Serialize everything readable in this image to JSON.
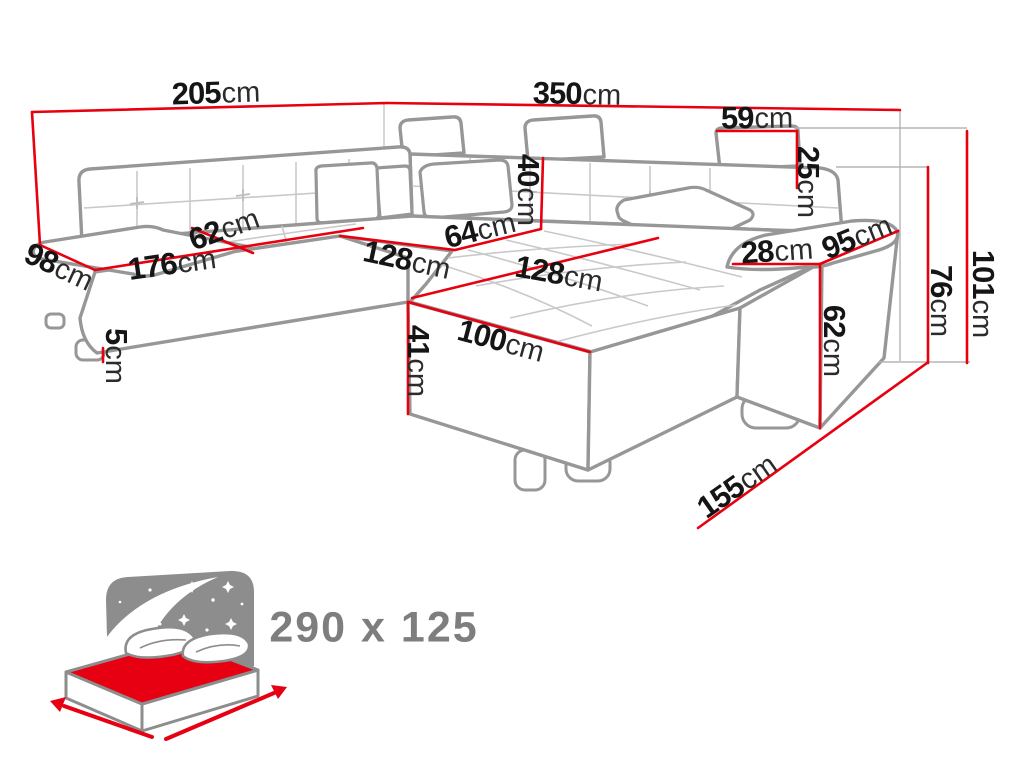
{
  "diagram": {
    "type": "sofa-dimension-diagram",
    "unit_default": "cm",
    "colors": {
      "dimension_line": "#e8000f",
      "outline_gray": "#979797",
      "seam_gray": "#c9c9c9",
      "label_text": "#151515",
      "icon_gray": "#8d8d8d",
      "icon_text": "#7e7e7e",
      "mattress_red": "#e60012"
    }
  },
  "dimensions": [
    {
      "name": "back-width-left",
      "value": "205",
      "unit": "cm"
    },
    {
      "name": "back-width-right",
      "value": "350",
      "unit": "cm"
    },
    {
      "name": "headrest-width",
      "value": "59",
      "unit": "cm"
    },
    {
      "name": "headrest-height",
      "value": "25",
      "unit": "cm"
    },
    {
      "name": "total-height",
      "value": "101",
      "unit": "cm"
    },
    {
      "name": "backrest-height",
      "value": "76",
      "unit": "cm"
    },
    {
      "name": "armrest-height",
      "value": "62",
      "unit": "cm"
    },
    {
      "name": "armrest-length",
      "value": "95",
      "unit": "cm"
    },
    {
      "name": "armrest-width",
      "value": "28",
      "unit": "cm"
    },
    {
      "name": "backrest-depth",
      "value": "40",
      "unit": "cm"
    },
    {
      "name": "seat-depth-corner",
      "value": "64",
      "unit": "cm"
    },
    {
      "name": "seat-depth-left",
      "value": "62",
      "unit": "cm"
    },
    {
      "name": "chaise-end-width",
      "value": "98",
      "unit": "cm"
    },
    {
      "name": "seat-length-left",
      "value": "176",
      "unit": "cm"
    },
    {
      "name": "seat-length-middle",
      "value": "128",
      "unit": "cm"
    },
    {
      "name": "seat-length-front",
      "value": "128",
      "unit": "cm"
    },
    {
      "name": "chaise-width",
      "value": "100",
      "unit": "cm"
    },
    {
      "name": "seat-height",
      "value": "41",
      "unit": "cm"
    },
    {
      "name": "leg-height",
      "value": "5",
      "unit": "cm"
    },
    {
      "name": "front-side-length",
      "value": "155",
      "unit": "cm"
    }
  ],
  "sleeping_area": {
    "label": "290 x 125"
  }
}
